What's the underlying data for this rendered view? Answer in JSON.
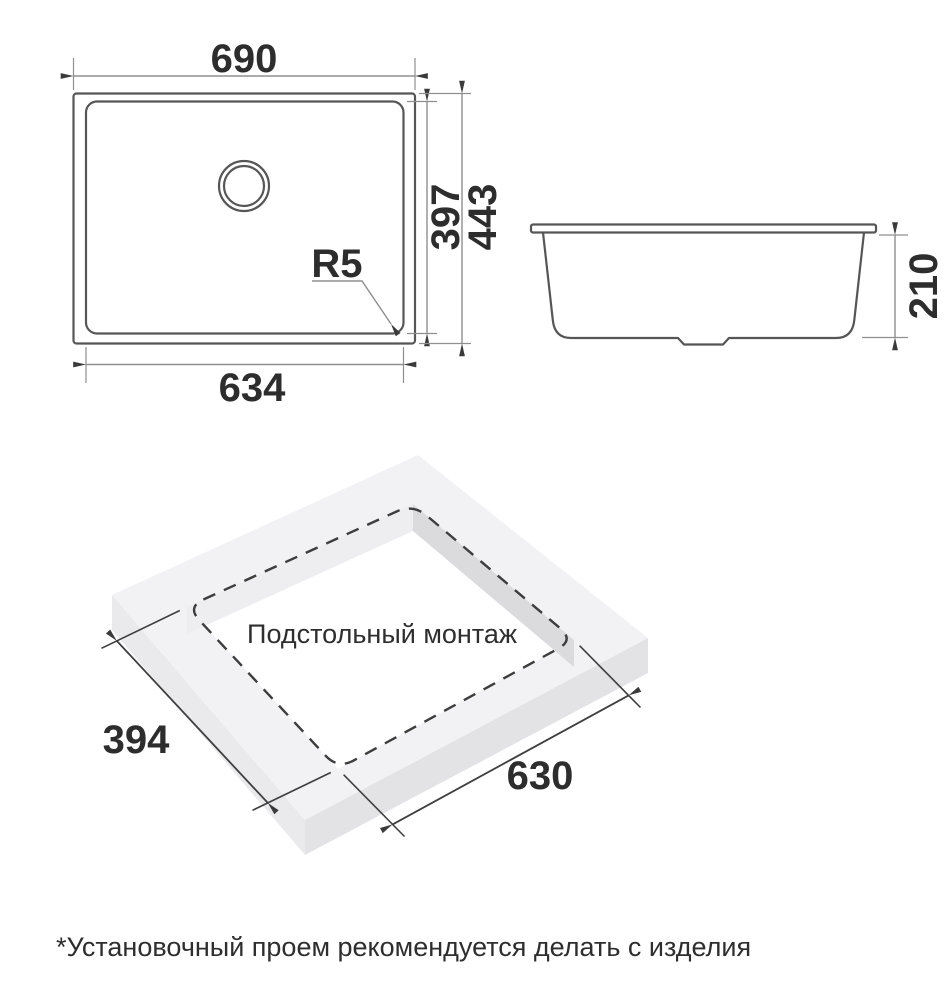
{
  "top_view": {
    "overall_width": "690",
    "bowl_width": "634",
    "bowl_depth": "397",
    "overall_depth": "443",
    "corner_radius": "R5"
  },
  "side_view": {
    "bowl_height": "210"
  },
  "installation_view": {
    "caption": "Подстольный монтаж",
    "cutout_length": "630",
    "cutout_width": "394"
  },
  "footnote": "*Установочный проем рекомендуется делать с изделия",
  "colors": {
    "background": "#ffffff",
    "outline": "#565656",
    "dashed_line": "#3d3d3d",
    "dimension_line": "#8f8f8f",
    "iso_dimension_line": "#3f3f3f",
    "arrowhead": "#3a3a3a",
    "text": "#2d2d2d",
    "slab_top": "#f2f2f4",
    "slab_side_left": "#eaeaec",
    "slab_side_right": "#e3e3e6",
    "cutout_wall_light": "#eeeef0",
    "cutout_wall_dark": "#dbdbdd"
  }
}
